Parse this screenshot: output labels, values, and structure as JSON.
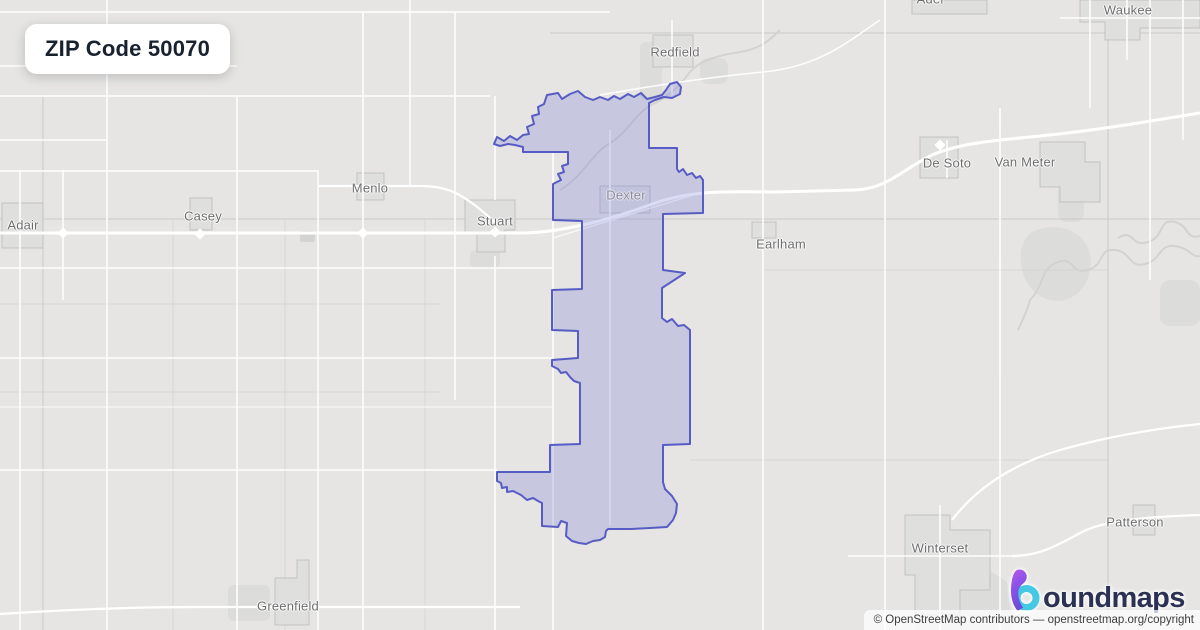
{
  "badge": {
    "title": "ZIP Code 50070"
  },
  "map": {
    "labels": [
      {
        "name": "adel",
        "text": "Adel"
      },
      {
        "name": "waukee",
        "text": "Waukee"
      },
      {
        "name": "redfield",
        "text": "Redfield"
      },
      {
        "name": "de-soto",
        "text": "De Soto"
      },
      {
        "name": "van-meter",
        "text": "Van Meter"
      },
      {
        "name": "menlo",
        "text": "Menlo"
      },
      {
        "name": "casey",
        "text": "Casey"
      },
      {
        "name": "adair",
        "text": "Adair"
      },
      {
        "name": "stuart",
        "text": "Stuart"
      },
      {
        "name": "dexter",
        "text": "Dexter"
      },
      {
        "name": "earlham",
        "text": "Earlham"
      },
      {
        "name": "winterset",
        "text": "Winterset"
      },
      {
        "name": "patterson",
        "text": "Patterson"
      },
      {
        "name": "greenfield",
        "text": "Greenfield"
      }
    ],
    "boundary": {
      "zip": "50070",
      "stroke_color": "#575cc4",
      "fill_color": "rgba(102,107,214,0.24)",
      "points": "494,144 500,146 508,144 515,145 523,147 523,152 568,152 568,164 562,166 564,172 558,174 561,180 553,184 553,220 582,221 582,289 552,290 552,330 578,331 578,358 552,360 552,366 558,369 561,373 566,372 570,377 574,381 580,383 580,444 550,445 550,472 497,472 497,481 501,483 502,488 507,487 507,492 513,491 521,495 527,500 533,498 538,501 542,503 542,526 558,527 561,521 567,523 566,536 572,541 579,543 586,544 593,541 600,540 605,537 606,531 608,529 630,529 650,528 667,527 673,520 676,513 677,504 672,496 665,489 663,482 663,445 690,444 690,330 684,325 678,326 672,319 667,322 662,318 662,288 685,273 663,270 663,214 703,213 703,180 700,176 696,178 692,173 687,175 683,169 679,172 677,169 677,148 649,148 649,103 655,100 664,97 672,98 680,94 681,87 677,82 670,84 666,90 662,95 655,97 647,99 641,93 634,97 628,94 620,99 614,96 608,100 600,97 593,100 585,97 578,91 570,94 562,99 558,93 547,95 544,104 538,107 539,114 532,116 534,124 527,127 529,134 523,135 517,140 510,136 504,141 497,137"
    }
  },
  "logo": {
    "wordmark": "boundmaps",
    "text_after_mark": "oundmaps",
    "navy": "#2b3152",
    "cyan": "#44c8e4",
    "purple_top": "#bb59ee",
    "purple_bottom": "#6a4bd6"
  },
  "attribution": {
    "text": "© OpenStreetMap contributors — openstreetmap.org/copyright"
  }
}
